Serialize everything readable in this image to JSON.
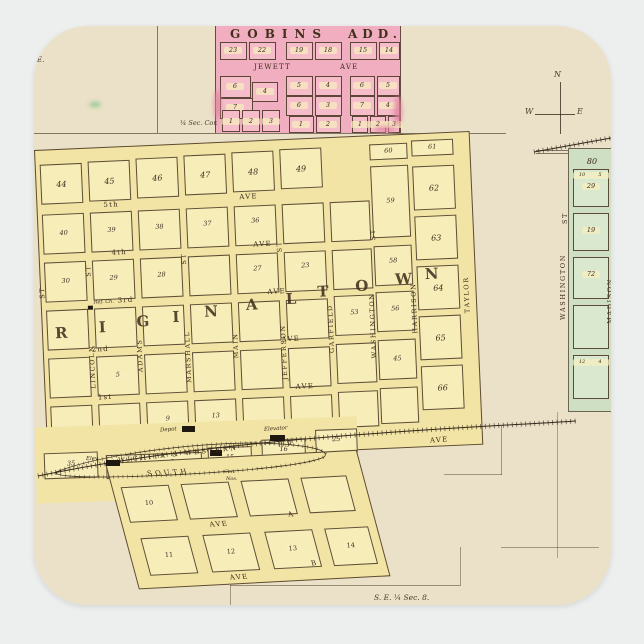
{
  "colors": {
    "page_background": "#edefef",
    "paper": "#ebe1c8",
    "gobins_pink": "#f0aec0",
    "town_yellow": "#f1e4a4",
    "green_town": "#cfdfc4",
    "ink": "#43301f"
  },
  "gobins_add": {
    "title": "GOBINS",
    "title_suffix": "ADD.",
    "top_blocks": [
      "23",
      "22",
      "19",
      "18",
      "15",
      "14"
    ],
    "street_name": "JEWETT",
    "street_type": "AVE",
    "group1_lots": [
      "6",
      "4",
      "7",
      "1",
      "2",
      "3"
    ],
    "group2_lots": [
      "5",
      "4",
      "6",
      "3",
      "1",
      "2"
    ],
    "group3_lots": [
      "6",
      "5",
      "7",
      "4",
      "1",
      "2",
      "3"
    ]
  },
  "survey": {
    "quarter_section_corner": "¼ Sec. Cor.",
    "southeast_quarter": "S. E. ¼ Sec. 8.",
    "southwest_quarter": "¼ Sec. 8.",
    "east_fragment": "E."
  },
  "compass": {
    "north": "N",
    "west": "W",
    "east": "E"
  },
  "original_town": {
    "name_letters_1": [
      "R",
      "I",
      "G",
      "I",
      "N",
      "A",
      "L"
    ],
    "name_letters_2": [
      "T",
      "O",
      "W",
      "N"
    ],
    "numbered_streets": [
      "5th",
      "4th",
      "3rd",
      "2nd",
      "1st"
    ],
    "avenue_label": "AVE",
    "street_label": "ST",
    "vertical_streets": [
      "LINCOLN",
      "ADAMS",
      "MARSHALL",
      "MAIN",
      "JEFFERSON",
      "GARFIELD",
      "WASHINGTON",
      "HARRISON",
      "TAYLOR"
    ],
    "top_blocks": [
      "44",
      "45",
      "46",
      "47",
      "48",
      "49",
      "60",
      "61"
    ],
    "east_blocks": [
      "62",
      "63",
      "64",
      "65",
      "66"
    ],
    "inner_blocks": [
      "40",
      "39",
      "38",
      "37",
      "36",
      "59",
      "30",
      "29",
      "28",
      "27",
      "23",
      "58",
      "53",
      "56",
      "5",
      "45",
      "9",
      "13"
    ],
    "church_label": "Ref. Ch."
  },
  "railroad": {
    "name": "WICHITA & WESTERN",
    "abbrev": "R.R.",
    "depot": "Depot",
    "elevator": "Elevator",
    "elevator_short": "Elev.",
    "note_1": "Con.",
    "note_2": "Nos."
  },
  "south_addition": {
    "south_street": "SOUTH",
    "avenue_label": "AVE",
    "avenue_a": "A",
    "avenue_b": "B",
    "blocks": [
      "10",
      "11",
      "12",
      "13",
      "14"
    ],
    "rail_blocks": [
      "35",
      "15",
      "16",
      "25"
    ],
    "rail_lots": [
      "5",
      "6",
      "7"
    ]
  },
  "green_town": {
    "acreage": "80",
    "blocks": [
      "29",
      "19",
      "72"
    ],
    "washington": "WASHINGTON",
    "street_label": "ST",
    "madison": "MADISON",
    "lots": [
      "10",
      "5",
      "12",
      "4"
    ]
  }
}
